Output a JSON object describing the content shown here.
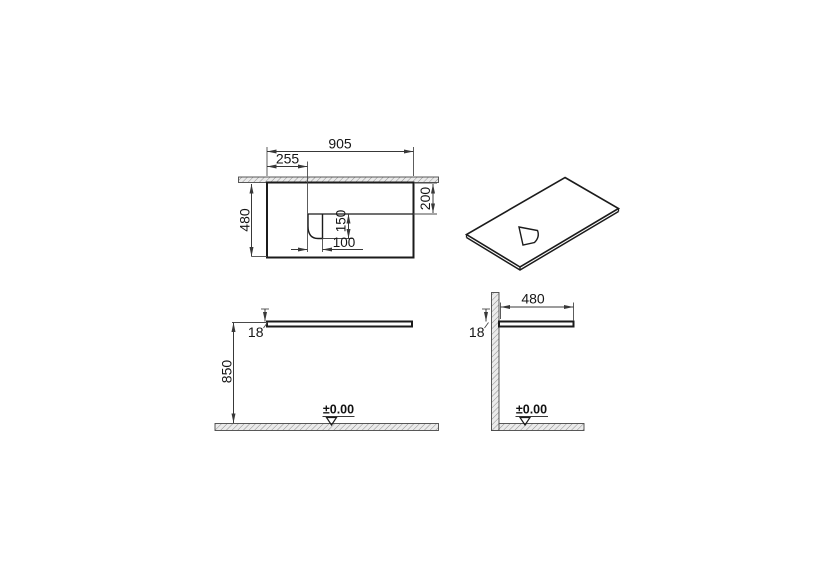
{
  "drawing": {
    "colors": {
      "line": "#1b1b1b",
      "dimension": "#383838",
      "hatch_fill": "#ebebeb",
      "hatch_stroke": "#8d8d8d",
      "background": "#ffffff"
    },
    "front_view": {
      "dim_width": "905",
      "dim_cutout_offset": "255",
      "dim_height": "480",
      "dim_recess_depth": "200",
      "dim_cutout_height": "150",
      "dim_cutout_width": "100"
    },
    "elevation_view": {
      "dim_thickness": "18",
      "dim_height_from_floor": "850",
      "datum_label": "±0.00"
    },
    "section_view": {
      "dim_depth": "480",
      "dim_thickness": "18",
      "datum_label": "±0.00"
    }
  }
}
